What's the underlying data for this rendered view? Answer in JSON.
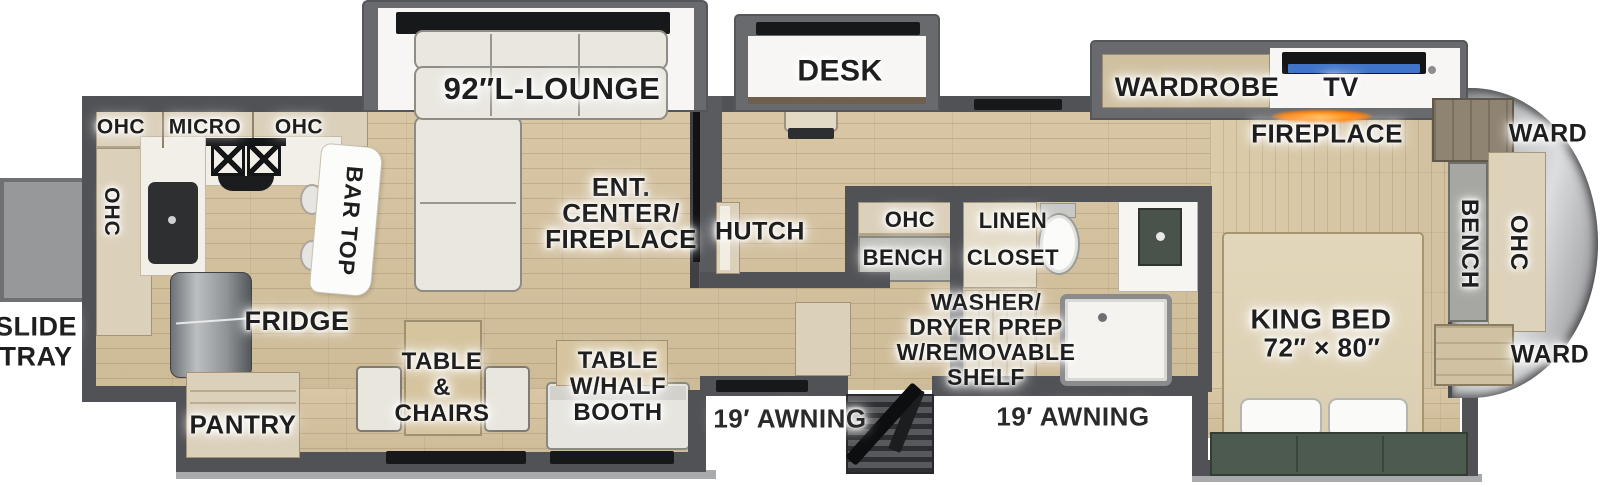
{
  "labels": {
    "slide_tray": "SLIDE\nTRAY",
    "kitchen_ohc_top_left": "OHC",
    "kitchen_micro": "MICRO",
    "kitchen_ohc_top_right": "OHC",
    "kitchen_ohc_side": "OHC",
    "bar_top": "BAR TOP",
    "lounge": "92″L-LOUNGE",
    "ent_center": "ENT.\nCENTER/\nFIREPLACE",
    "desk": "DESK",
    "hutch": "HUTCH",
    "mid_ohc": "OHC",
    "mid_bench": "BENCH",
    "linen_closet": "LINEN\nCLOSET",
    "wardrobe": "WARDROBE",
    "tv": "TV",
    "fireplace": "FIREPLACE",
    "ward_front_top": "WARD",
    "front_bench": "BENCH",
    "front_ohc": "OHC",
    "ward_front_bottom": "WARD",
    "king_bed": "KING BED",
    "king_bed_size": "72″ × 80″",
    "washer_prep": "WASHER/\nDRYER PREP\nW/REMOVABLE\nSHELF",
    "fridge": "FRIDGE",
    "pantry": "PANTRY",
    "table_chairs": "TABLE\n&\nCHAIRS",
    "table_half_booth": "TABLE\nW/HALF\nBOOTH",
    "awning_door_left": "19′ AWNING",
    "awning_door_right": "19′ AWNING"
  },
  "colors": {
    "wall_gray": "#515256",
    "floor_wood": "#d3c09e",
    "cabinet_tan": "#dbd0ba",
    "slide_interior_white": "#f7f6f4",
    "sofa_cream": "#e9e7e0",
    "tv_accent_blue": "#3f74c8",
    "fireplace_orange": "#ff7a00",
    "front_cap_silver": "#c9cacc",
    "bed_beige": "#e0d4b8",
    "bed_bench_green": "#4d5a4f",
    "label_text": "#1e1e1e"
  }
}
